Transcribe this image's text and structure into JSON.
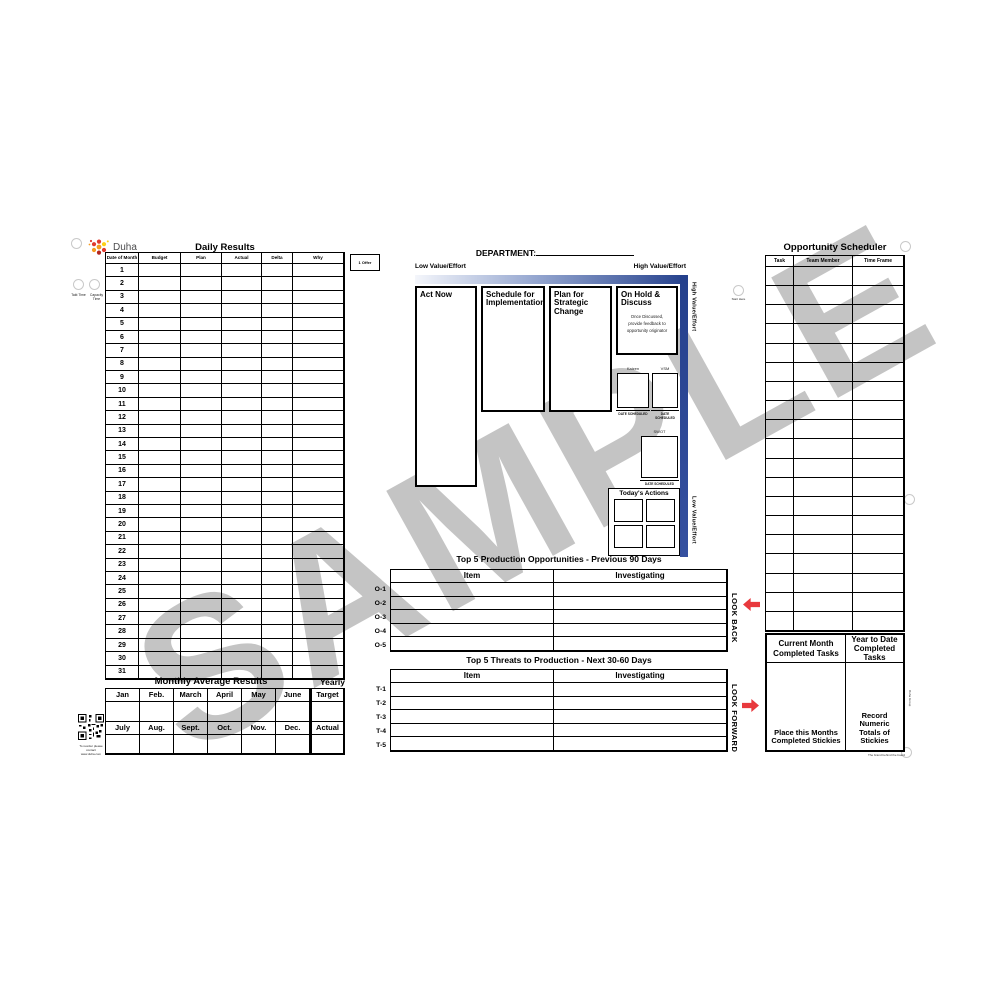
{
  "branding": {
    "logo_text": "Duha"
  },
  "watermark": "SAMPLE",
  "daily_results": {
    "title": "Daily Results",
    "columns": [
      "Date of Month",
      "Budget",
      "Plan",
      "Actual",
      "Delta",
      "Why"
    ],
    "dates": [
      "1",
      "2",
      "3",
      "4",
      "5",
      "6",
      "7",
      "8",
      "9",
      "10",
      "11",
      "12",
      "13",
      "14",
      "15",
      "16",
      "17",
      "18",
      "19",
      "20",
      "21",
      "22",
      "23",
      "24",
      "25",
      "26",
      "27",
      "28",
      "29",
      "30",
      "31"
    ],
    "offer_label": "1 Offer",
    "hole_label_left": "Takt Time",
    "hole_label_right": "Capacity Time"
  },
  "monthly_average": {
    "title": "Monthly Average Results",
    "yearly_label": "Yearly",
    "months_row1": [
      "Jan",
      "Feb.",
      "March",
      "April",
      "May",
      "June"
    ],
    "months_row2": [
      "July",
      "Aug.",
      "Sept.",
      "Oct.",
      "Nov.",
      "Dec."
    ],
    "yearly_row1": "Target",
    "yearly_row2": "Actual"
  },
  "qr_note": {
    "line1": "To reorder please contact",
    "line2": "www.duha.com"
  },
  "matrix": {
    "department_label": "DEPARTMENT:",
    "low_label": "Low Value/Effort",
    "high_label": "High Value/Effort",
    "side_high_label": "High Value/Effort",
    "side_low_label": "Low Value/Effort",
    "quadrant1": "Act Now",
    "quadrant2": "Schedule for Implementation",
    "quadrant3": "Plan for Strategic Change",
    "quadrant4": "On Hold & Discuss",
    "quadrant4_note1": "Once Discussed,",
    "quadrant4_note2": "provide feedback to",
    "quadrant4_note3": "opportunity originator",
    "box_kaizen": "Kaizen",
    "box_vsm": "VSM",
    "box_swot": "SWOT",
    "date_scheduled": "DATE SCHEDULED",
    "todays_actions": "Today's Actions",
    "start_here": "Start Here"
  },
  "opportunities": {
    "title": "Top 5 Production Opportunities - Previous 90 Days",
    "col_item": "Item",
    "col_investigating": "Investigating",
    "rows": [
      "O-1",
      "O-2",
      "O-3",
      "O-4",
      "O-5"
    ],
    "side_label": "LOOK BACK"
  },
  "threats": {
    "title": "Top 5 Threats to Production - Next 30-60 Days",
    "col_item": "Item",
    "col_investigating": "Investigating",
    "rows": [
      "T-1",
      "T-2",
      "T-3",
      "T-4",
      "T-5"
    ],
    "side_label": "LOOK FORWARD"
  },
  "scheduler": {
    "title": "Opportunity Scheduler",
    "columns": [
      "Task",
      "Team Member",
      "Time Frame"
    ],
    "row_count": 19
  },
  "completed": {
    "left_header_1": "Current Month",
    "left_header_2": "Completed Tasks",
    "right_header_1": "Year to Date",
    "right_header_2": "Completed Tasks",
    "left_footer_1": "Place this Months",
    "left_footer_2": "Completed Stickies",
    "right_footer_1": "Record Numeric",
    "right_footer_2": "Totals of Stickies",
    "side_note": "Duha Group",
    "bottom_note": "The brand behind the board"
  },
  "colors": {
    "navy": "#24408c",
    "red": "#e8393d",
    "watermark_gray": "#8a8a8a"
  }
}
